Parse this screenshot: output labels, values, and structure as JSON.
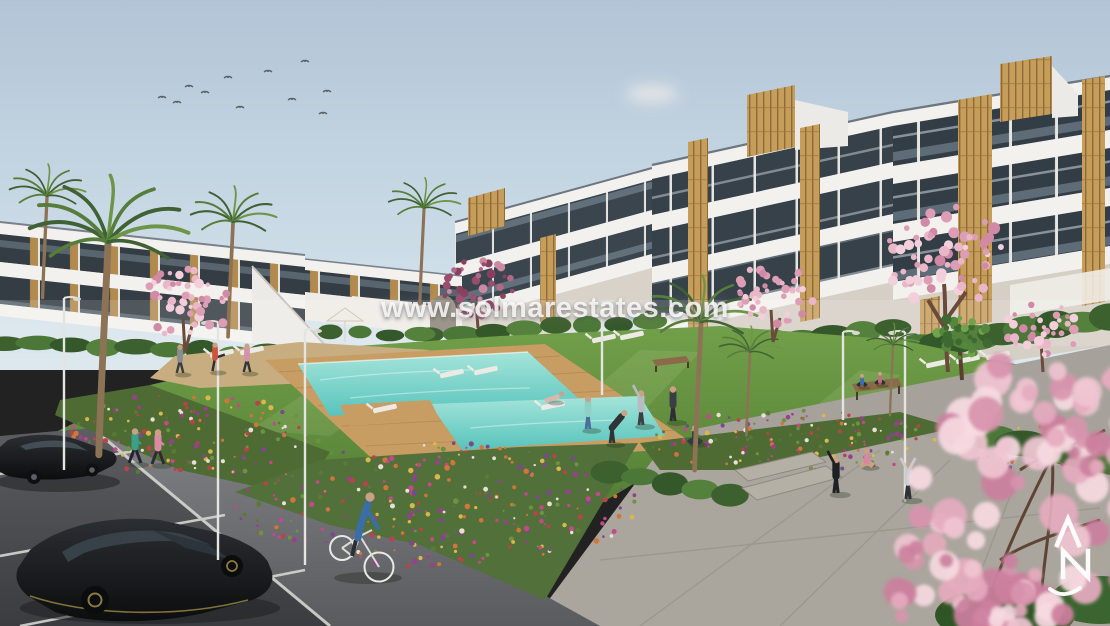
{
  "watermark": {
    "text": "www.solmarestates.com",
    "color": "#fcfcfa"
  },
  "logo": {
    "letters": "AN",
    "swoosh_glyph": "~",
    "color": "#ffffff"
  },
  "scene": {
    "setting": "new-build apartment complex with communal pool, gardens, plaza and parking",
    "sky": {
      "birds_visible": 11,
      "cloud_position": "upper-right"
    },
    "counts": {
      "black_cars": 2,
      "joggers": 2,
      "cyclists": 1,
      "people_on_lawn_and_plaza": 13,
      "street_lamps": 6
    },
    "palette": {
      "sky_top": "#b2c4d6",
      "sky_horizon": "#dde8ee",
      "cloud": "#e7e0dd",
      "building_white": "#f3f1ed",
      "window_glass": "#323d46",
      "wood_accent": "#c59e5c",
      "lawn": "#63913e",
      "hedge": "#436b32",
      "pool_water": "#72cfc7",
      "pool_deck": "#c79d63",
      "blossom_pink": "#e5aec2",
      "flower_magenta": "#c2498a",
      "flower_orange": "#d2753b",
      "pavement": "#a6a29b",
      "road": "#6f7073",
      "parking_asphalt": "#4a4b4e",
      "car_black": "#1d1f22"
    },
    "elements": [
      "apartment-blocks",
      "palm-trees",
      "cherry-blossom-trees",
      "swimming-pool",
      "sun-loungers",
      "parasol",
      "lawn",
      "flower-beds",
      "benches",
      "street-lamps",
      "parking-lot",
      "black-cars",
      "cyclist",
      "joggers",
      "people-exercising",
      "paved-plaza",
      "foreground-blossom-branches"
    ]
  }
}
